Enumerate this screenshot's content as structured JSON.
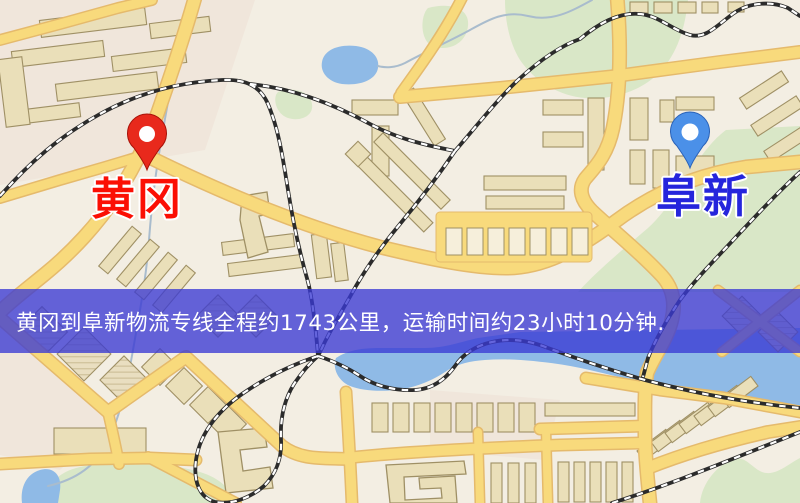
{
  "banner": {
    "text": "黄冈到阜新物流专线全程约1743公里，运输时间约23小时10分钟.",
    "background": "rgba(58,58,212,0.78)",
    "text_color": "#ffffff"
  },
  "markers": {
    "origin": {
      "label": "黄冈",
      "pin_color": "#e8291c",
      "pin_edge": "#a81208",
      "label_color": "#fb0f04",
      "transform": "translate(147,170)"
    },
    "destination": {
      "label": "阜新",
      "pin_color": "#4b90e8",
      "pin_edge": "#2a62b8",
      "label_color": "#2525dc",
      "transform": "translate(690,168)"
    }
  },
  "map": {
    "background": "#f3eee3",
    "district_tint": "#ecd9cf",
    "road_fill": "#f8da7c",
    "road_casing": "#e5ba6c",
    "water": "#8fbae6",
    "stream": "#a9bccd",
    "green": "#d9e7c7",
    "building_fill": "#eadfb9",
    "building_stroke": "#9f9065",
    "railway_dark": "#2b2b2b",
    "railway_dash": "#ffffff"
  }
}
